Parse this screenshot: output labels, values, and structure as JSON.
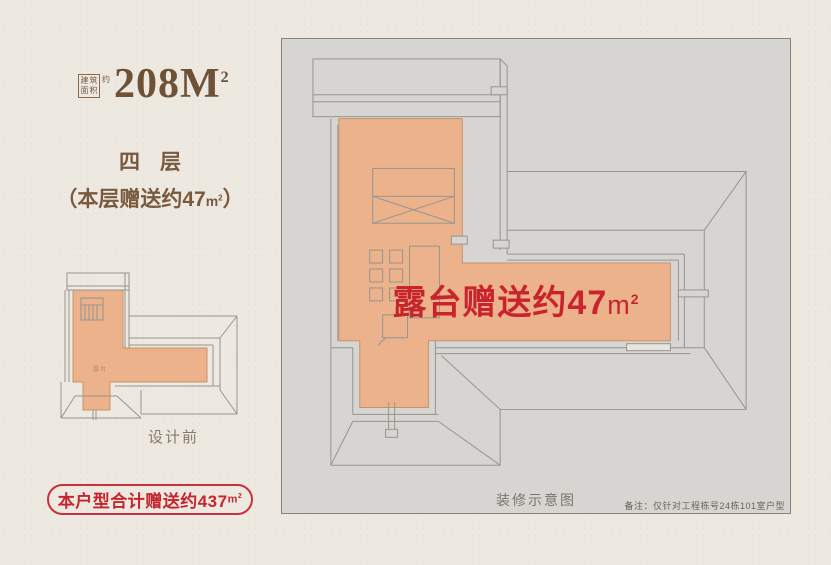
{
  "colors": {
    "page_bg": "#EDE9E1",
    "brown_text": "#7A5A3E",
    "title_brown": "#6F5136",
    "red_accent": "#C4252F",
    "panel_bg": "#D6D5D1",
    "panel_border": "#8C8375",
    "terrace_fill": "#EBB28C",
    "roof_line": "#97948E",
    "caption_gray": "#7E756C"
  },
  "header": {
    "area_chars": {
      "c1": "建",
      "c2": "筑",
      "c3": "面",
      "c4": "积"
    },
    "approx": "约",
    "number": "208M",
    "sup": "2"
  },
  "floor": {
    "title": "四层",
    "gift_prefix": "（本层赠送约47",
    "gift_unit": "m",
    "gift_sup": "2",
    "gift_suffix": "）"
  },
  "thumbnail": {
    "terrace_label": "露台",
    "caption": "设计前"
  },
  "total_badge": {
    "prefix": "本户型合计赠送约437",
    "unit": "m",
    "sup": "2"
  },
  "plan": {
    "annotation_prefix": "露台赠送约47",
    "annotation_unit": "m",
    "annotation_sup": "2",
    "caption": "装修示意图",
    "note": "备注：仅针对工程栋号24栋101室户型"
  }
}
